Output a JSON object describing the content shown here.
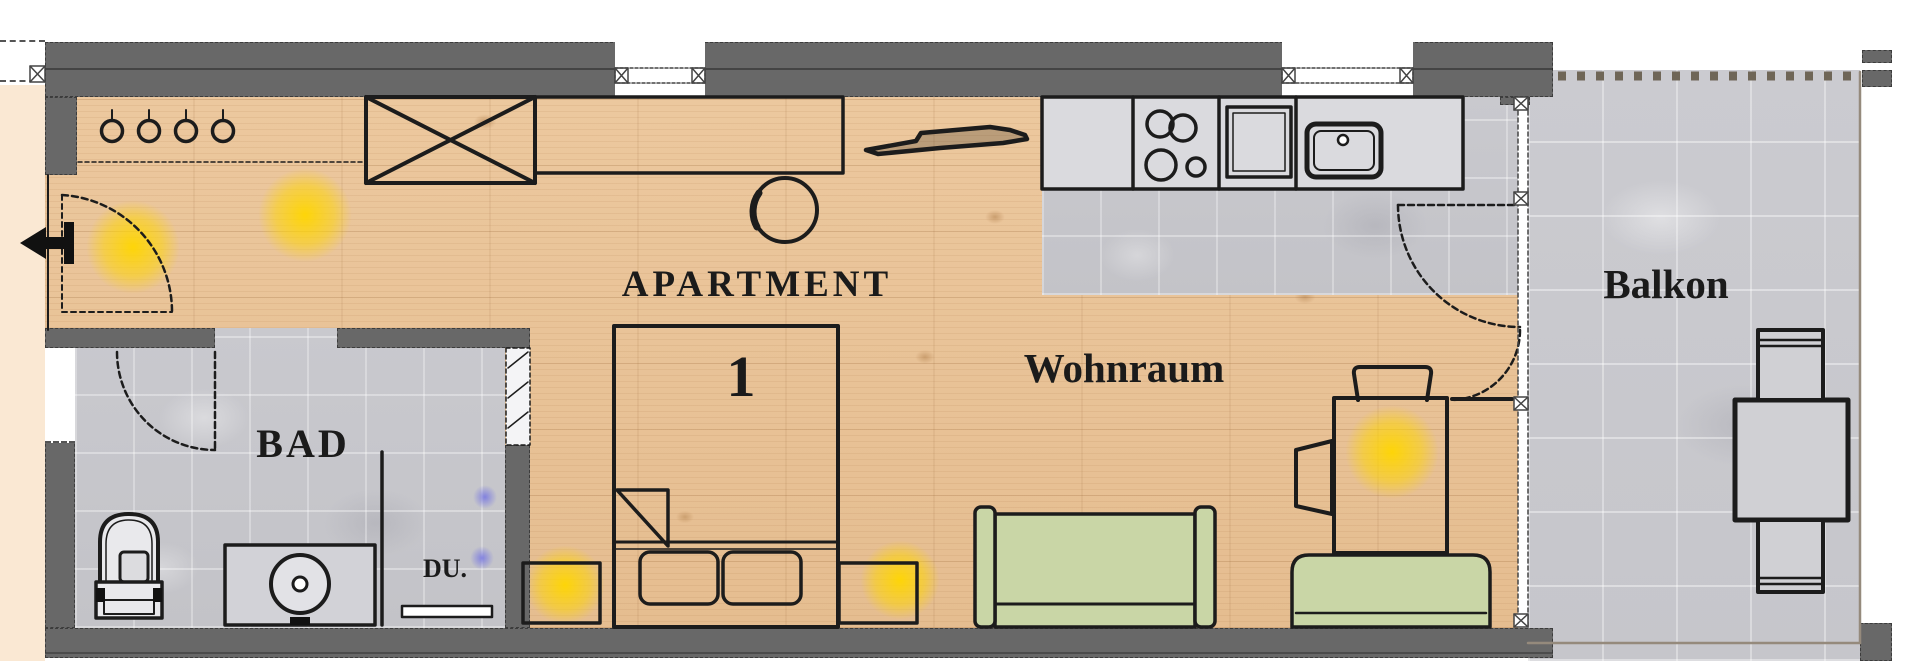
{
  "labels": {
    "apartment": "APARTMENT",
    "unit_number": "1",
    "living_room": "Wohnraum",
    "bathroom": "BAD",
    "shower": "DU.",
    "balcony": "Balkon"
  },
  "colors": {
    "wall_gray": "#686868",
    "wood_floor": "#e8c49c",
    "tile_floor": "#c8c8cc",
    "furniture_green": "#c9d6a6",
    "light_glow_yellow": "#ffd600",
    "light_glow_blue": "#7676e2",
    "line_black": "#1c1c1c",
    "hall_beige": "#fae8d3"
  }
}
